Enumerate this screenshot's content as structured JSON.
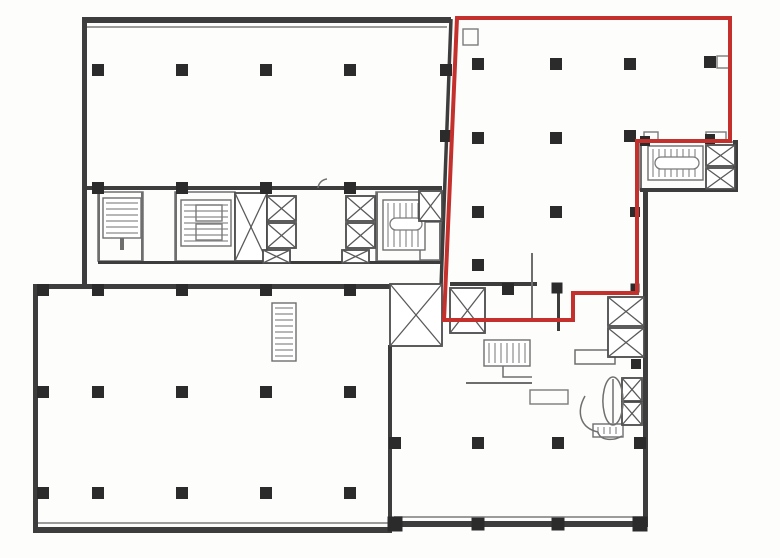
{
  "plan": {
    "canvas": {
      "width": 780,
      "height": 558,
      "background": "#fdfdfc"
    },
    "colors": {
      "wall": "#3d3d3d",
      "partition": "#6e6e6e",
      "window_line": "#9c9c9c",
      "hatch": "#8c8c8c",
      "column": "#2b2b2b",
      "shaft_stroke": "#4a4a4a",
      "shaft_cross": "#5a5a5a",
      "fixture": "#7b7b7b",
      "curve": "#6f6f6f",
      "highlight": "#c4302c"
    },
    "highlight": {
      "stroke_width": 4,
      "points": [
        [
          457,
          18
        ],
        [
          730,
          18
        ],
        [
          730,
          141
        ],
        [
          637,
          141
        ],
        [
          637,
          293
        ],
        [
          573,
          293
        ],
        [
          573,
          320
        ],
        [
          444,
          320
        ]
      ]
    },
    "walls": [
      [
        82,
        17,
        369,
        6
      ],
      [
        82,
        17,
        5,
        271
      ],
      [
        33,
        284,
        358,
        5
      ],
      [
        33,
        284,
        5,
        249
      ],
      [
        33,
        527,
        359,
        6
      ],
      [
        388,
        345,
        4,
        182
      ],
      [
        390,
        521,
        258,
        6
      ],
      [
        643,
        190,
        5,
        337
      ],
      [
        640,
        188,
        97,
        4
      ],
      [
        733,
        140,
        5,
        52
      ],
      [
        450,
        282,
        87,
        4
      ],
      [
        557,
        283,
        3,
        48
      ],
      [
        82,
        186,
        360,
        4
      ],
      [
        98,
        261,
        343,
        3
      ]
    ],
    "partitions": [
      [
        98,
        192,
        2,
        69
      ],
      [
        141,
        192,
        2,
        69
      ],
      [
        175,
        192,
        2,
        69
      ],
      [
        376,
        192,
        2,
        69
      ],
      [
        439,
        192,
        2,
        69
      ],
      [
        531,
        253,
        2,
        67
      ],
      [
        640,
        142,
        2,
        46
      ],
      [
        466,
        382,
        66,
        2
      ],
      [
        120,
        205,
        4,
        45
      ]
    ],
    "window_lines": [
      [
        87,
        26,
        360,
        2
      ],
      [
        38,
        522,
        350,
        2
      ],
      [
        394,
        516,
        250,
        2
      ]
    ],
    "room_outlines": [
      [
        98,
        192,
        45,
        69
      ],
      [
        175,
        192,
        60,
        69
      ],
      [
        376,
        192,
        65,
        69
      ],
      [
        640,
        142,
        94,
        48
      ],
      [
        420,
        222,
        21,
        38
      ],
      [
        575,
        350,
        40,
        14
      ]
    ],
    "lines": [
      [
        451,
        19,
        441,
        287,
        3.5
      ],
      [
        441,
        287,
        441,
        321,
        3
      ]
    ],
    "stairs": [
      {
        "x": 103,
        "y": 198,
        "w": 38,
        "h": 40,
        "dir": "h"
      },
      {
        "x": 181,
        "y": 200,
        "w": 50,
        "h": 46,
        "dir": "h"
      },
      {
        "x": 383,
        "y": 200,
        "w": 42,
        "h": 50,
        "dir": "v",
        "pill": [
          390,
          218,
          32,
          12
        ]
      },
      {
        "x": 648,
        "y": 146,
        "w": 55,
        "h": 34,
        "dir": "v",
        "pill": [
          655,
          157,
          44,
          12
        ]
      },
      {
        "x": 272,
        "y": 303,
        "w": 24,
        "h": 58,
        "dir": "h"
      },
      {
        "x": 484,
        "y": 340,
        "w": 46,
        "h": 26,
        "dir": "v"
      },
      {
        "x": 593,
        "y": 424,
        "w": 30,
        "h": 13,
        "dir": "v"
      }
    ],
    "shafts": [
      [
        235,
        193,
        32,
        68
      ],
      [
        267,
        196,
        29,
        25
      ],
      [
        267,
        223,
        29,
        25
      ],
      [
        263,
        250,
        27,
        13
      ],
      [
        346,
        196,
        29,
        25
      ],
      [
        346,
        223,
        29,
        25
      ],
      [
        342,
        250,
        27,
        13
      ],
      [
        419,
        191,
        23,
        30
      ],
      [
        706,
        145,
        29,
        21
      ],
      [
        706,
        168,
        29,
        21
      ],
      [
        608,
        297,
        36,
        29
      ],
      [
        608,
        328,
        36,
        29
      ],
      [
        390,
        284,
        52,
        62
      ],
      [
        450,
        288,
        35,
        45
      ],
      [
        622,
        378,
        20,
        23
      ],
      [
        622,
        402,
        20,
        23
      ]
    ],
    "fixtures": [
      [
        463,
        29,
        15,
        16
      ],
      [
        717,
        56,
        12,
        12
      ],
      [
        644,
        132,
        14,
        8
      ],
      [
        706,
        132,
        20,
        8
      ],
      [
        530,
        390,
        38,
        14
      ],
      [
        196,
        205,
        26,
        16
      ],
      [
        196,
        224,
        26,
        16
      ]
    ],
    "curves": [
      "M318,188 A10,10 0 0 1 327,179",
      "M503,366 L503,377 L532,377",
      "M585,396 C576,412 580,428 598,432",
      "M598,432 C600,441 614,441 622,436",
      "M613,377 A10,24 0 1 1 612.9,377 Z",
      "M613,379 L613,423"
    ],
    "columns": [
      [
        98,
        70
      ],
      [
        182,
        70
      ],
      [
        266,
        70
      ],
      [
        350,
        70
      ],
      [
        98,
        188
      ],
      [
        182,
        188
      ],
      [
        266,
        188
      ],
      [
        350,
        188
      ],
      [
        446,
        70
      ],
      [
        446,
        136
      ],
      [
        478,
        64
      ],
      [
        556,
        64
      ],
      [
        630,
        64
      ],
      [
        710,
        62
      ],
      [
        478,
        138
      ],
      [
        556,
        138
      ],
      [
        630,
        136
      ],
      [
        478,
        212
      ],
      [
        556,
        212
      ],
      [
        478,
        265
      ],
      [
        508,
        289
      ],
      [
        557,
        288,
        11
      ],
      [
        635,
        212,
        10
      ],
      [
        635,
        288,
        9
      ],
      [
        645,
        141,
        10
      ],
      [
        710,
        139,
        10
      ],
      [
        636,
        364,
        10
      ],
      [
        43,
        290
      ],
      [
        98,
        290
      ],
      [
        182,
        290
      ],
      [
        266,
        290
      ],
      [
        350,
        290
      ],
      [
        43,
        392
      ],
      [
        98,
        392
      ],
      [
        182,
        392
      ],
      [
        266,
        392
      ],
      [
        350,
        392
      ],
      [
        43,
        493
      ],
      [
        98,
        493
      ],
      [
        182,
        493
      ],
      [
        266,
        493
      ],
      [
        350,
        493
      ],
      [
        395,
        443
      ],
      [
        478,
        443
      ],
      [
        558,
        443
      ],
      [
        640,
        443
      ],
      [
        395,
        524,
        15
      ],
      [
        478,
        524,
        13
      ],
      [
        558,
        524,
        13
      ],
      [
        640,
        524,
        15
      ]
    ]
  }
}
